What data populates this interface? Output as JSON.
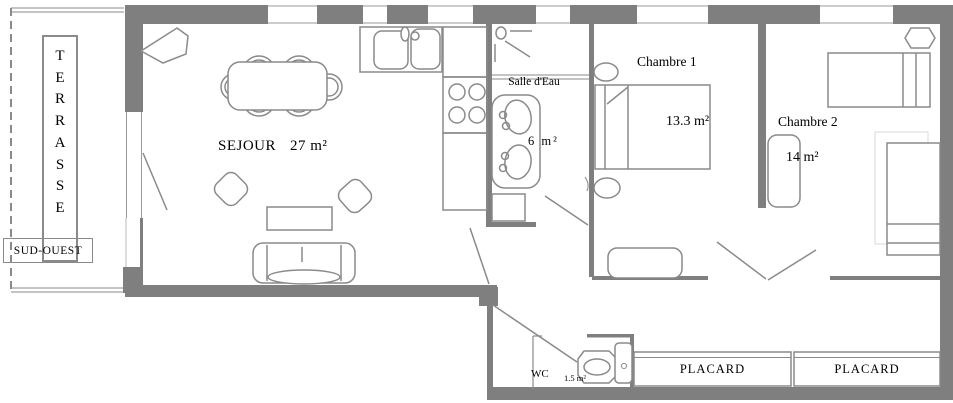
{
  "colors": {
    "wall": "#7f7f7f",
    "line": "#8a8a8a",
    "faint_line": "#d8d8d8",
    "text": "#000000",
    "background": "#ffffff"
  },
  "terrace": {
    "letters": [
      "T",
      "E",
      "R",
      "R",
      "A",
      "S",
      "S",
      "E"
    ],
    "direction": "SUD-OUEST"
  },
  "rooms": {
    "sejour": {
      "name": "SEJOUR",
      "area": "27 m²"
    },
    "salle_eau": {
      "name": "Salle d'Eau",
      "area": "6 m²"
    },
    "chambre1": {
      "name": "Chambre 1",
      "area": "13.3 m²"
    },
    "chambre2": {
      "name": "Chambre 2",
      "area": "14 m²"
    },
    "wc": {
      "name": "WC",
      "area": "1.5 m²"
    },
    "placards": [
      {
        "name": "PLACARD"
      },
      {
        "name": "PLACARD"
      }
    ]
  }
}
